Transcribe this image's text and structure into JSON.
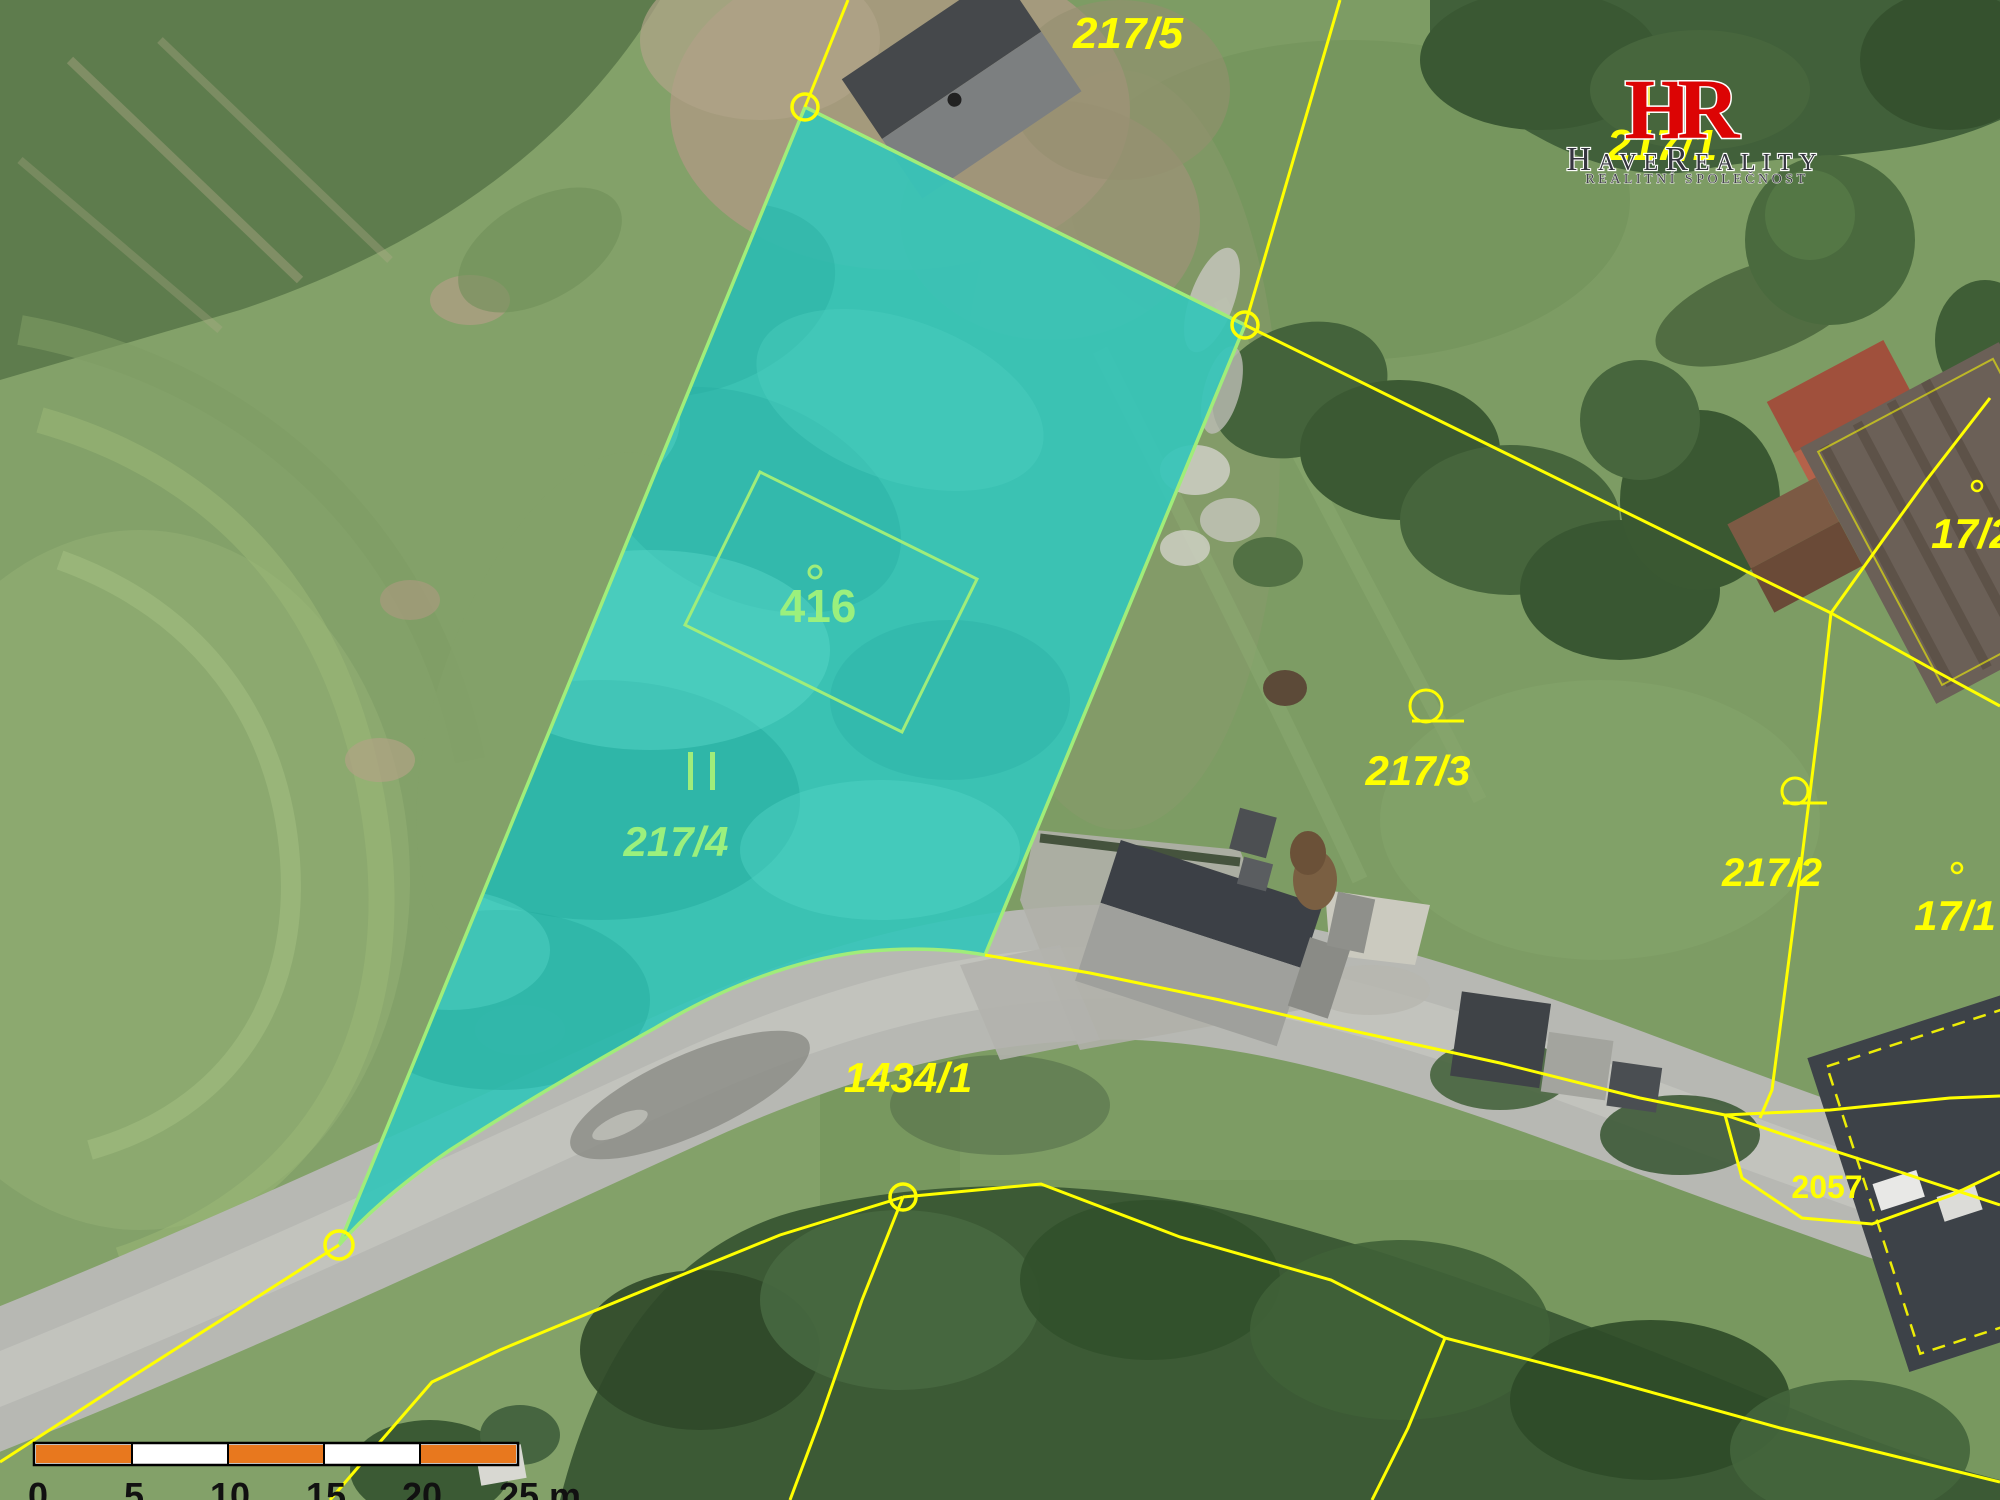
{
  "map": {
    "type": "cadastral-aerial-map",
    "highlighted_parcel": "217/4",
    "labels": {
      "p217_5": "217/5",
      "p217_1": "217/1",
      "p17_2": "17/2",
      "p217_3": "217/3",
      "p217_2": "217/2",
      "p17_1": "17/1",
      "p2057": "2057",
      "p1434_1": "1434/1",
      "p217_4": "217/4",
      "p416": "416"
    },
    "colors": {
      "boundary_line": "#ffff00",
      "highlight_fill": "#36c5b9",
      "highlight_outline": "#a0ed7a",
      "highlight_label": "#9bf07d",
      "outside_label": "#ffff00"
    },
    "symbols": [
      "vertex-circle",
      "land-use-circle-symbol",
      "building-point",
      "double-tick"
    ]
  },
  "scalebar": {
    "ticks": [
      "0",
      "5",
      "10",
      "15",
      "20",
      "25 m"
    ],
    "segment_meters": 5,
    "orange": "#e8781e",
    "white": "#ffffff"
  },
  "logo": {
    "monogram_h": "H",
    "monogram_r": "R",
    "name": "HaveReality",
    "tagline": "REALITNÍ SPOLEČNOST",
    "monogram_color": "#dc0404"
  }
}
